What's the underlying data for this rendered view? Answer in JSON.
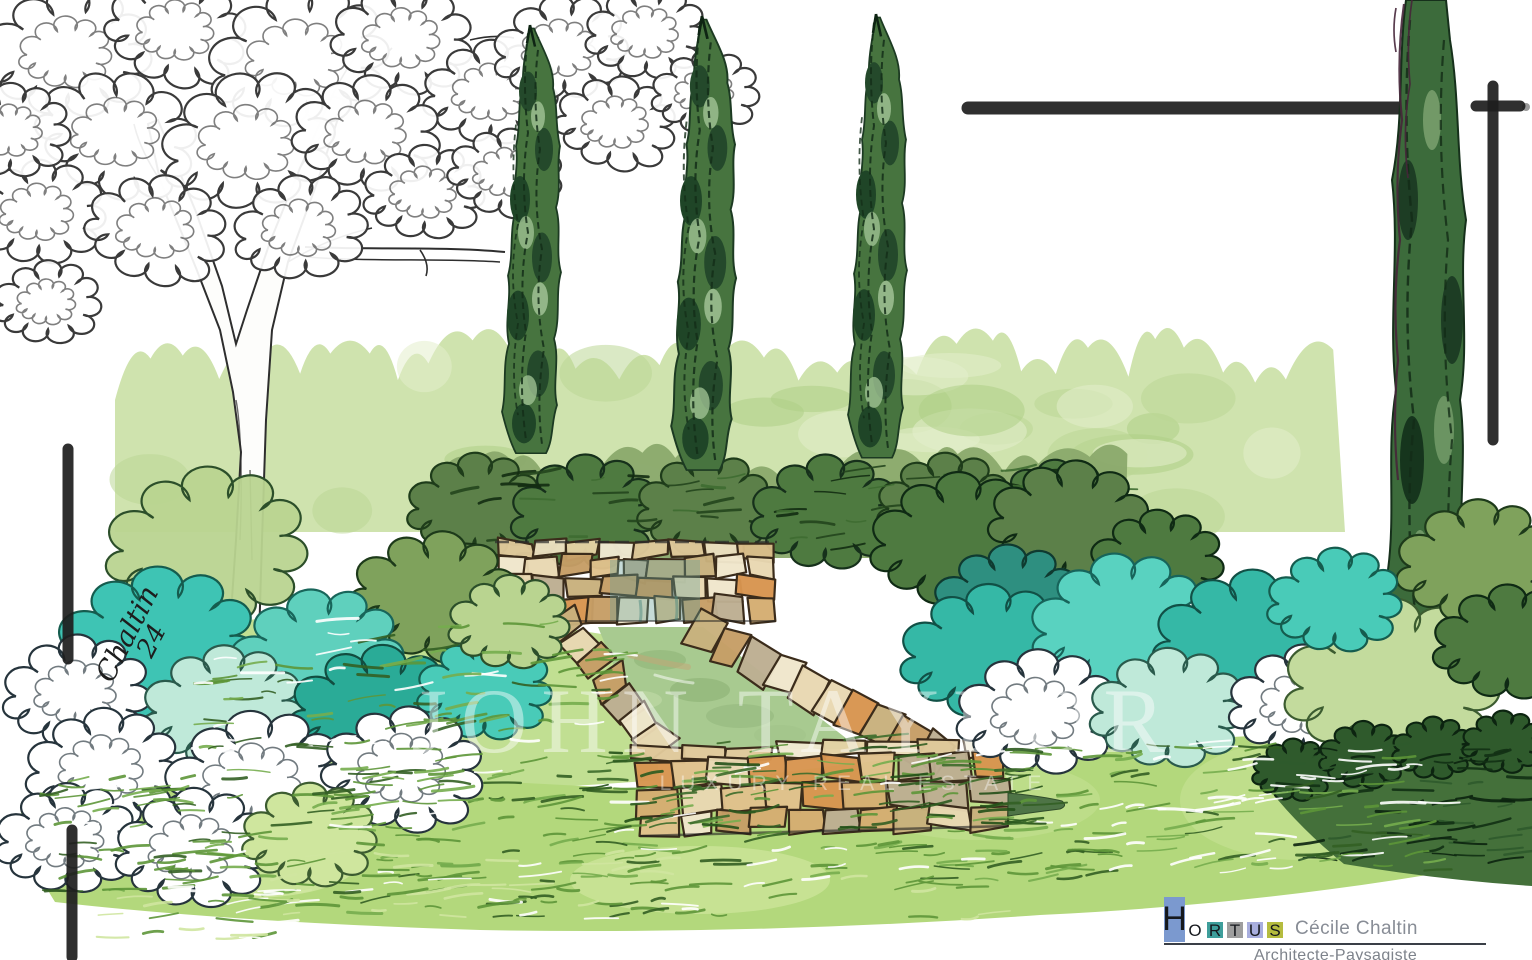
{
  "watermark": {
    "line1": "JOHN TAYLOR",
    "line2": "LUXURY REAL ESTATE"
  },
  "signature": {
    "name": "Chaltin",
    "year": "24"
  },
  "logo": {
    "brand_letters": [
      {
        "ch": "H",
        "block": "#7b99cf",
        "tall": true
      },
      {
        "ch": "O",
        "block": ""
      },
      {
        "ch": "R",
        "block": "#3e9e9b"
      },
      {
        "ch": "T",
        "block": "#9e9e9e"
      },
      {
        "ch": "U",
        "block": "#a8aede"
      },
      {
        "ch": "S",
        "block": "#b5bc3f"
      }
    ],
    "name": "Cécile Chaltin",
    "title": "Architecte-Paysagiste"
  },
  "palette": {
    "cypress_green": "#3c6b3b",
    "hedge_green": "#cfe3ae",
    "turquoise": "#3ec4b4",
    "mint": "#bfe9d9",
    "stone_tan": "#d5ad72",
    "stone_orange": "#d8954f",
    "water_green": "#a8ca90",
    "lawn_green": "#b3d87c",
    "ink": "#2b2b2b",
    "registration_mark": "#1e1e1e"
  }
}
